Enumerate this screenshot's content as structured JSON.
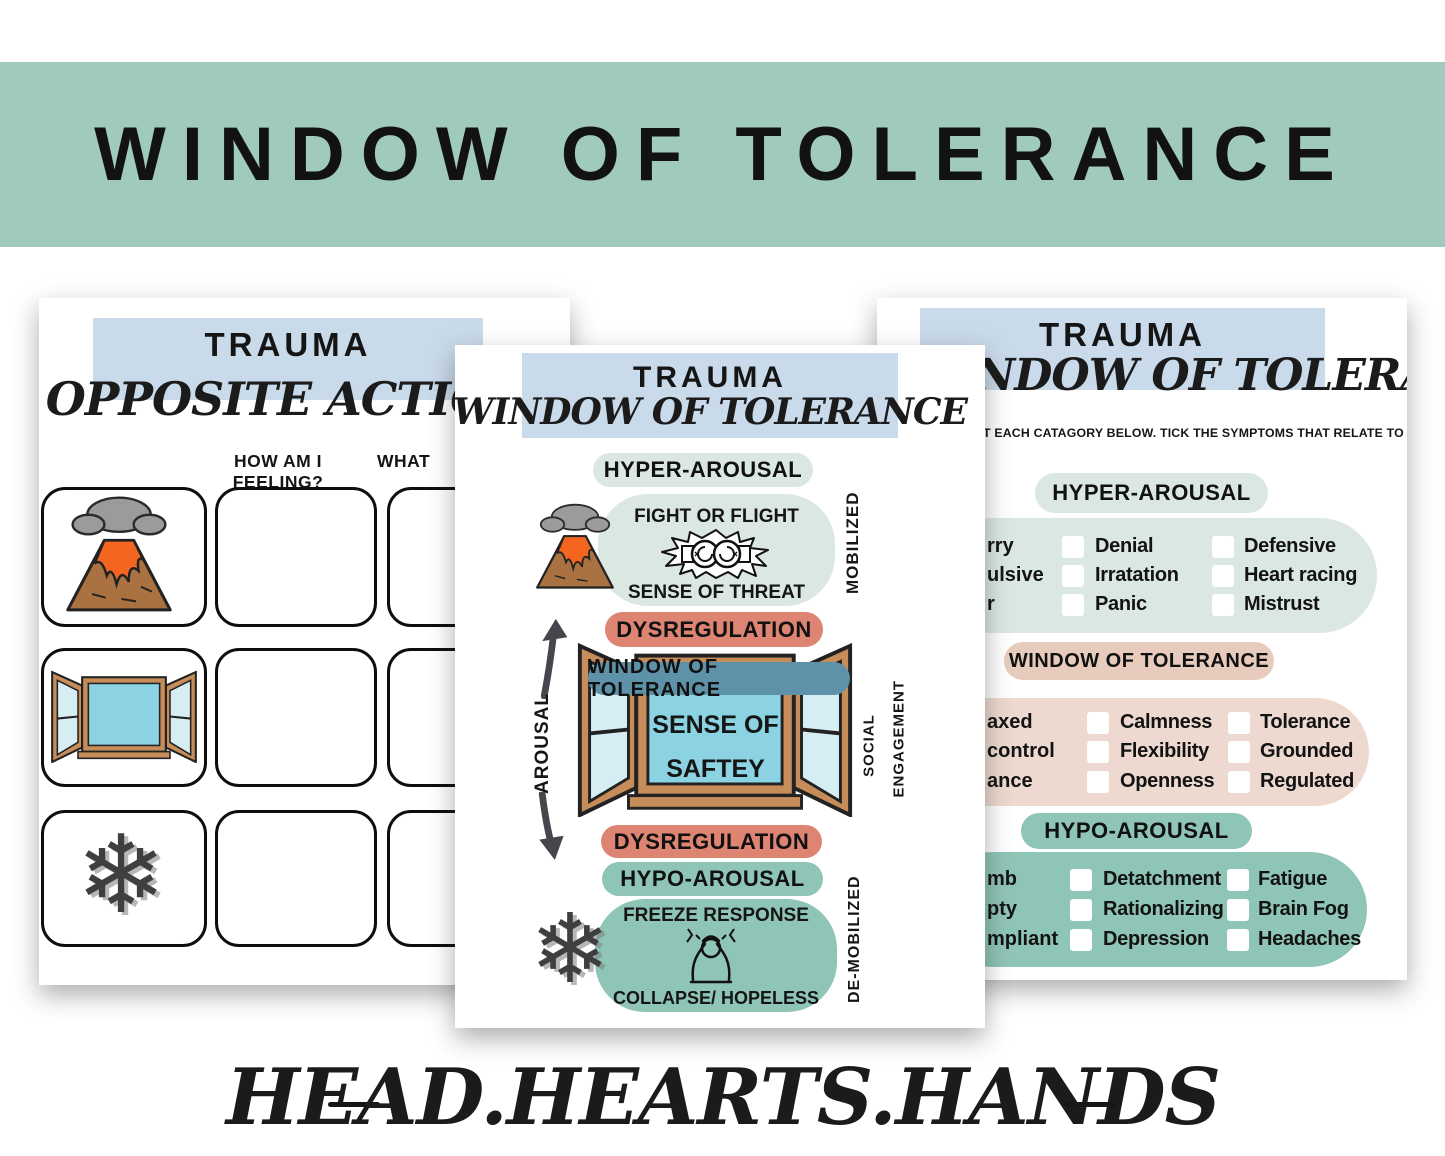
{
  "banner": {
    "title": "WINDOW OF TOLERANCE"
  },
  "footer": {
    "brand": "HEAD.HEARTS.HANDS"
  },
  "glyphs": {
    "snowflake": "❄"
  },
  "colors": {
    "banner_green": "#a0cabd",
    "header_blue": "#c9daea",
    "light_teal": "#dbe8e2",
    "salmon": "#dd8472",
    "steel_blue": "#5e92a9",
    "teal": "#8fc5b7",
    "pink_box": "#edd9cf",
    "pink_pill": "#e7ccbe",
    "window_pane": "#8bd3e3",
    "frame_brown": "#c68d5a"
  },
  "left_page": {
    "title": "TRAUMA",
    "subtitle": "OPPOSITE ACTION",
    "question_1": "HOW AM I FEELING?",
    "question_2_fragment": "WHAT"
  },
  "center_page": {
    "title": "TRAUMA",
    "subtitle": "WINDOW OF TOLERANCE",
    "hyper_label": "HYPER-AROUSAL",
    "fight_or_flight": "FIGHT OR FLIGHT",
    "sense_of_threat": "SENSE OF THREAT",
    "mobilized": "MOBILIZED",
    "dysregulation_top": "DYSREGULATION",
    "window_label": "WINDOW OF TOLERANCE",
    "sense_line1": "SENSE OF",
    "sense_line2": "SAFTEY",
    "arousal": "AROUSAL",
    "social": "SOCIAL",
    "engagement": "ENGAGEMENT",
    "dysregulation_bottom": "DYSREGULATION",
    "hypo_label": "HYPO-AROUSAL",
    "freeze_response": "FREEZE RESPONSE",
    "collapse_hopeless": "COLLAPSE/ HOPELESS",
    "demobilized": "DE-MOBILIZED"
  },
  "right_page": {
    "title": "TRAUMA",
    "subtitle_fragment": "NDOW OF TOLERANCE",
    "instruction_fragment": "T EACH CATAGORY BELOW. TICK THE SYMPTOMS THAT RELATE TO YOU",
    "sections": [
      {
        "label": "HYPER-AROUSAL",
        "col1_fragments": [
          "rry",
          "ulsive",
          "r"
        ],
        "col2": [
          "Denial",
          "Irratation",
          "Panic"
        ],
        "col3": [
          "Defensive",
          "Heart racing",
          "Mistrust"
        ]
      },
      {
        "label": "WINDOW OF TOLERANCE",
        "col1_fragments": [
          "axed",
          "control",
          "ance"
        ],
        "col2": [
          "Calmness",
          "Flexibility",
          "Openness"
        ],
        "col3": [
          "Tolerance",
          "Grounded",
          "Regulated"
        ]
      },
      {
        "label": "HYPO-AROUSAL",
        "col1_fragments": [
          "mb",
          "pty",
          "mpliant"
        ],
        "col2": [
          "Detatchment",
          "Rationalizing",
          "Depression"
        ],
        "col3": [
          "Fatigue",
          "Brain Fog",
          "Headaches"
        ]
      }
    ]
  }
}
